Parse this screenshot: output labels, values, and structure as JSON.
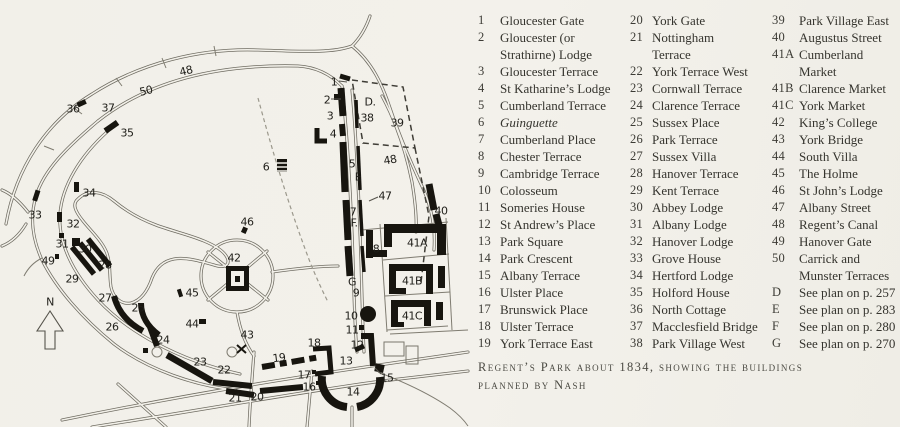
{
  "caption": {
    "line1": "Regent’s Park about 1834, showing the buildings",
    "line2": "planned by Nash"
  },
  "legend": {
    "columns": [
      {
        "items": [
          {
            "num": "1",
            "label": "Gloucester Gate"
          },
          {
            "num": "2",
            "label": "Gloucester (or",
            "label2": "Strathirne) Lodge"
          },
          {
            "num": "3",
            "label": "Gloucester Terrace"
          },
          {
            "num": "4",
            "label": "St Katharine’s Lodge"
          },
          {
            "num": "5",
            "label": "Cumberland Terrace"
          },
          {
            "num": "6",
            "label": "Guinguette",
            "italic": true
          },
          {
            "num": "7",
            "label": "Cumberland Place"
          },
          {
            "num": "8",
            "label": "Chester Terrace"
          },
          {
            "num": "9",
            "label": "Cambridge Terrace"
          },
          {
            "num": "10",
            "label": "Colosseum"
          },
          {
            "num": "11",
            "label": "Someries House"
          },
          {
            "num": "12",
            "label": "St Andrew’s Place"
          },
          {
            "num": "13",
            "label": "Park Square"
          },
          {
            "num": "14",
            "label": "Park Crescent"
          },
          {
            "num": "15",
            "label": "Albany Terrace"
          },
          {
            "num": "16",
            "label": "Ulster Place"
          },
          {
            "num": "17",
            "label": "Brunswick Place"
          },
          {
            "num": "18",
            "label": "Ulster Terrace"
          },
          {
            "num": "19",
            "label": "York Terrace East"
          }
        ]
      },
      {
        "items": [
          {
            "num": "20",
            "label": "York Gate"
          },
          {
            "num": "21",
            "label": "Nottingham",
            "label2": "Terrace"
          },
          {
            "num": "22",
            "label": "York Terrace West"
          },
          {
            "num": "23",
            "label": "Cornwall Terrace"
          },
          {
            "num": "24",
            "label": "Clarence Terrace"
          },
          {
            "num": "25",
            "label": "Sussex Place"
          },
          {
            "num": "26",
            "label": "Park Terrace"
          },
          {
            "num": "27",
            "label": "Sussex Villa"
          },
          {
            "num": "28",
            "label": "Hanover Terrace"
          },
          {
            "num": "29",
            "label": "Kent Terrace"
          },
          {
            "num": "30",
            "label": "Abbey Lodge"
          },
          {
            "num": "31",
            "label": "Albany Lodge"
          },
          {
            "num": "32",
            "label": "Hanover Lodge"
          },
          {
            "num": "33",
            "label": "Grove House"
          },
          {
            "num": "34",
            "label": "Hertford Lodge"
          },
          {
            "num": "35",
            "label": "Holford House"
          },
          {
            "num": "36",
            "label": "North Cottage"
          },
          {
            "num": "37",
            "label": "Macclesfield Bridge"
          },
          {
            "num": "38",
            "label": "Park Village West"
          }
        ]
      },
      {
        "items": [
          {
            "num": "39",
            "label": "Park Village East"
          },
          {
            "num": "40",
            "label": "Augustus Street"
          },
          {
            "num": "41A",
            "label": "Cumberland",
            "label2": "Market"
          },
          {
            "num": "41B",
            "label": "Clarence Market"
          },
          {
            "num": "41C",
            "label": "York Market"
          },
          {
            "num": "42",
            "label": "King’s College"
          },
          {
            "num": "43",
            "label": "York Bridge"
          },
          {
            "num": "44",
            "label": "South Villa"
          },
          {
            "num": "45",
            "label": "The Holme"
          },
          {
            "num": "46",
            "label": "St John’s Lodge"
          },
          {
            "num": "47",
            "label": "Albany Street"
          },
          {
            "num": "48",
            "label": "Regent’s Canal"
          },
          {
            "num": "49",
            "label": "Hanover Gate"
          },
          {
            "num": "50",
            "label": "Carrick and",
            "label2": "Munster Terraces"
          },
          {
            "num": "D",
            "label": "See plan on p. 257"
          },
          {
            "num": "E",
            "label": "See plan on p. 283"
          },
          {
            "num": "F",
            "label": "See plan on p. 280"
          },
          {
            "num": "G",
            "label": "See plan on p. 270"
          }
        ]
      }
    ]
  },
  "map": {
    "north_indicator": "N",
    "labels": [
      {
        "t": "48",
        "x": 186,
        "y": 71,
        "r": -14
      },
      {
        "t": "50",
        "x": 146,
        "y": 91,
        "r": -13
      },
      {
        "t": "36",
        "x": 73,
        "y": 109
      },
      {
        "t": "37",
        "x": 108,
        "y": 108
      },
      {
        "t": "35",
        "x": 127,
        "y": 133
      },
      {
        "t": "34",
        "x": 89,
        "y": 193
      },
      {
        "t": "33",
        "x": 35,
        "y": 215
      },
      {
        "t": "32",
        "x": 73,
        "y": 224
      },
      {
        "t": "31",
        "x": 62,
        "y": 244
      },
      {
        "t": "30",
        "x": 85,
        "y": 249
      },
      {
        "t": "49",
        "x": 48,
        "y": 261
      },
      {
        "t": "28",
        "x": 105,
        "y": 265
      },
      {
        "t": "29",
        "x": 72,
        "y": 279
      },
      {
        "t": "27",
        "x": 105,
        "y": 298
      },
      {
        "t": "25",
        "x": 138,
        "y": 308
      },
      {
        "t": "26",
        "x": 112,
        "y": 327
      },
      {
        "t": "24",
        "x": 163,
        "y": 340
      },
      {
        "t": "45",
        "x": 192,
        "y": 293
      },
      {
        "t": "44",
        "x": 192,
        "y": 324
      },
      {
        "t": "46",
        "x": 247,
        "y": 222
      },
      {
        "t": "42",
        "x": 234,
        "y": 258
      },
      {
        "t": "43",
        "x": 247,
        "y": 335
      },
      {
        "t": "23",
        "x": 200,
        "y": 362
      },
      {
        "t": "22",
        "x": 224,
        "y": 370
      },
      {
        "t": "19",
        "x": 279,
        "y": 358,
        "r": -7
      },
      {
        "t": "21",
        "x": 235,
        "y": 398
      },
      {
        "t": "20",
        "x": 257,
        "y": 397
      },
      {
        "t": "18",
        "x": 314,
        "y": 343
      },
      {
        "t": "17",
        "x": 304,
        "y": 375
      },
      {
        "t": "16",
        "x": 309,
        "y": 387
      },
      {
        "t": "13",
        "x": 346,
        "y": 361
      },
      {
        "t": "14",
        "x": 353,
        "y": 392
      },
      {
        "t": "15",
        "x": 387,
        "y": 378
      },
      {
        "t": "12",
        "x": 357,
        "y": 345
      },
      {
        "t": "11",
        "x": 352,
        "y": 330
      },
      {
        "t": "10",
        "x": 351,
        "y": 316
      },
      {
        "t": "9",
        "x": 356,
        "y": 293
      },
      {
        "t": "G",
        "x": 352,
        "y": 282
      },
      {
        "t": "8",
        "x": 376,
        "y": 249
      },
      {
        "t": "F.",
        "x": 354,
        "y": 223
      },
      {
        "t": "7",
        "x": 353,
        "y": 212
      },
      {
        "t": "E",
        "x": 358,
        "y": 177
      },
      {
        "t": "5",
        "x": 352,
        "y": 164
      },
      {
        "t": "4",
        "x": 333,
        "y": 134
      },
      {
        "t": "3",
        "x": 330,
        "y": 116
      },
      {
        "t": "2",
        "x": 327,
        "y": 100
      },
      {
        "t": "1",
        "x": 334,
        "y": 82
      },
      {
        "t": "D.",
        "x": 370,
        "y": 102
      },
      {
        "t": "38",
        "x": 367,
        "y": 118
      },
      {
        "t": "39",
        "x": 397,
        "y": 123
      },
      {
        "t": "48",
        "x": 390,
        "y": 160,
        "r": -10
      },
      {
        "t": "47",
        "x": 385,
        "y": 196
      },
      {
        "t": "40",
        "x": 441,
        "y": 211
      },
      {
        "t": "41A",
        "x": 417,
        "y": 243
      },
      {
        "t": "41B",
        "x": 412,
        "y": 281
      },
      {
        "t": "41C",
        "x": 412,
        "y": 316
      },
      {
        "t": "6",
        "x": 266,
        "y": 167
      },
      {
        "t": "N",
        "x": 50,
        "y": 302
      }
    ]
  }
}
